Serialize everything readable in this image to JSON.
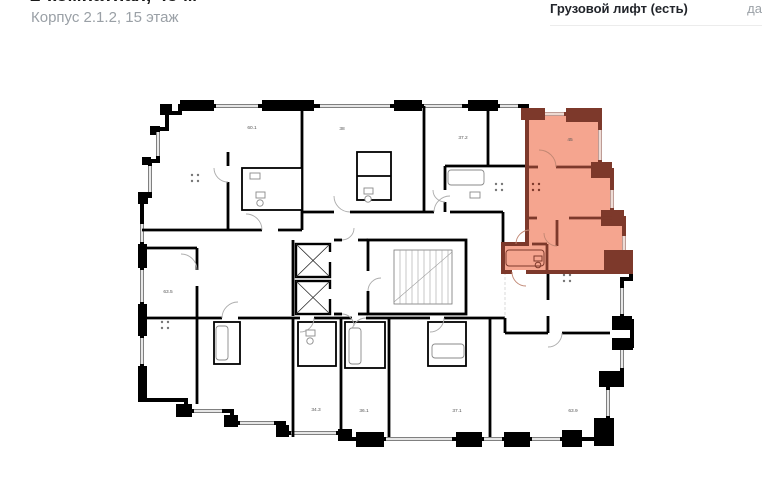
{
  "header": {
    "title": "2-комнатная, 45 м²",
    "subtitle": "Корпус 2.1.2, 15 этаж"
  },
  "info_panel": {
    "rows": [
      {
        "label": "Грузовой лифт (есть)",
        "value": "да"
      }
    ]
  },
  "plan": {
    "highlight": {
      "fill": "#F5A58F",
      "wall": "#7D392B"
    },
    "wall_color": "#000000",
    "labels": [
      {
        "room": "room-60-1",
        "text": "60.1"
      },
      {
        "room": "room-38",
        "text": "38"
      },
      {
        "room": "room-37-2",
        "text": "37.2"
      },
      {
        "room": "room-45-highlighted",
        "text": "45"
      },
      {
        "room": "room-63-5",
        "text": "63.5"
      },
      {
        "room": "room-34-3",
        "text": "34.3"
      },
      {
        "room": "room-36-1",
        "text": "36.1"
      },
      {
        "room": "room-37-1",
        "text": "37.1"
      },
      {
        "room": "room-63-9",
        "text": "63.9"
      }
    ]
  }
}
